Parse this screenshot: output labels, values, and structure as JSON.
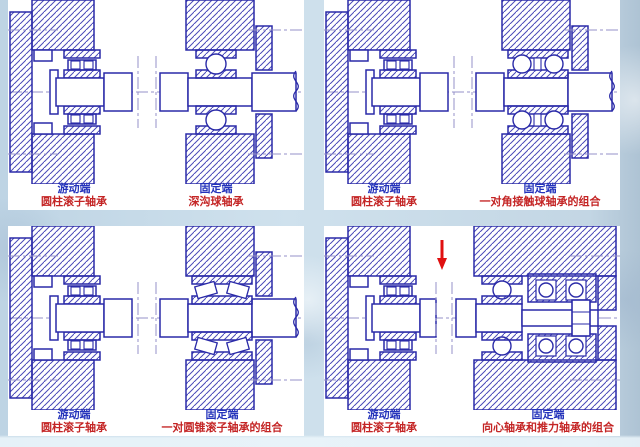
{
  "colors": {
    "page_background": "#c6dae8",
    "panel_background": "#ffffff",
    "drawing_line": "#2a2aa8",
    "hatch_line": "#4a4ab8",
    "centerline": "#9490c8",
    "label_blue": "#2433bb",
    "label_red": "#c42525",
    "arrow_red": "#e01010"
  },
  "panels": [
    {
      "id": "top-left",
      "left_bearing": "cylindrical-roller",
      "right_bearing": "deep-groove-ball",
      "left_label": {
        "title": "游动端",
        "subtitle": "圆柱滚子轴承"
      },
      "right_label": {
        "title": "固定端",
        "subtitle": "深沟球轴承"
      },
      "arrow": null
    },
    {
      "id": "top-right",
      "left_bearing": "cylindrical-roller",
      "right_bearing": "angular-contact-ball-pair",
      "left_label": {
        "title": "游动端",
        "subtitle": "圆柱滚子轴承"
      },
      "right_label": {
        "title": "固定端",
        "subtitle": "一对角接触球轴承的组合"
      },
      "arrow": null
    },
    {
      "id": "bottom-left",
      "left_bearing": "cylindrical-roller",
      "right_bearing": "tapered-roller-pair",
      "left_label": {
        "title": "游动端",
        "subtitle": "圆柱滚子轴承"
      },
      "right_label": {
        "title": "固定端",
        "subtitle": "一对圆锥滚子轴承的组合"
      },
      "arrow": null
    },
    {
      "id": "bottom-right",
      "left_bearing": "cylindrical-roller",
      "right_bearing": "radial-plus-thrust",
      "left_label": {
        "title": "游动端",
        "subtitle": "圆柱滚子轴承"
      },
      "right_label": {
        "title": "固定端",
        "subtitle": "向心轴承和推力轴承的组合"
      },
      "arrow": "red-down-arrow"
    }
  ]
}
